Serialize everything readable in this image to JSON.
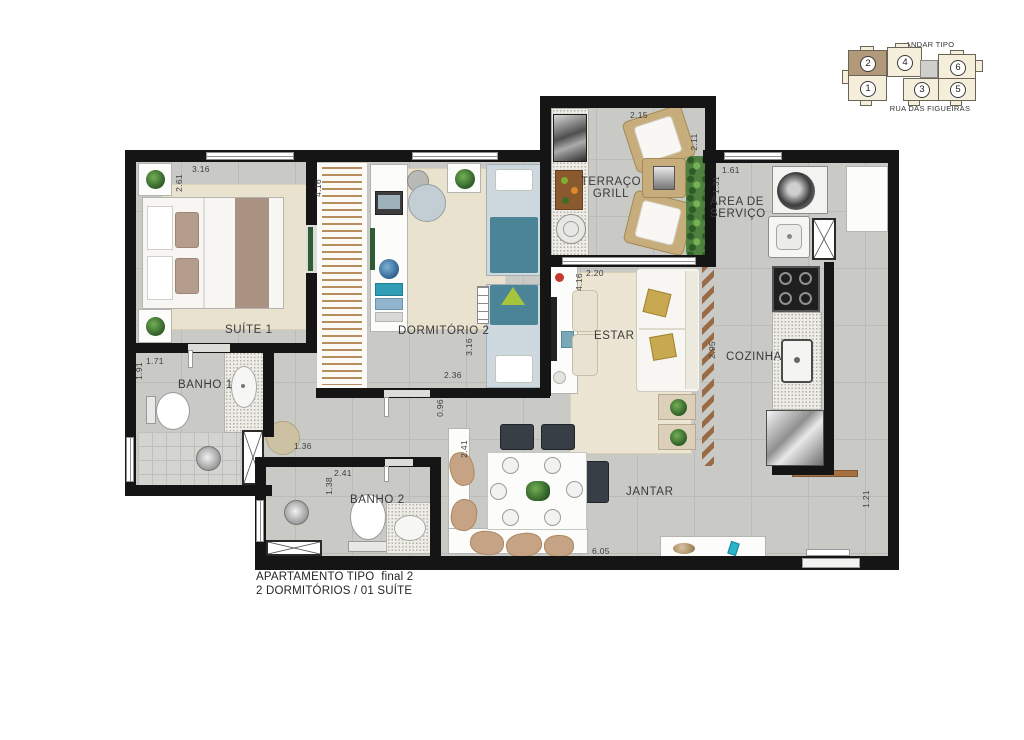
{
  "plan": {
    "caption_line1": "APARTAMENTO TIPO  final 2",
    "caption_line2": "2 DORMITÓRIOS / 01 SUÍTE"
  },
  "key_plan": {
    "title": "ANDAR TIPO",
    "street": "RUA DAS FIGUEIRAS",
    "highlighted_unit": "2",
    "units": [
      {
        "number": "2",
        "highlighted": true
      },
      {
        "number": "4",
        "highlighted": false
      },
      {
        "number": "6",
        "highlighted": false
      },
      {
        "number": "1",
        "highlighted": false
      },
      {
        "number": "3",
        "highlighted": false
      },
      {
        "number": "5",
        "highlighted": false
      }
    ]
  },
  "rooms": [
    {
      "id": "suite-1",
      "label": "SUÍTE 1"
    },
    {
      "id": "banho-1",
      "label": "BANHO 1"
    },
    {
      "id": "dormitorio-2",
      "label": "DORMITÓRIO 2"
    },
    {
      "id": "terraco-grill",
      "label": "TERRAÇO\nGRILL"
    },
    {
      "id": "area-de-servico",
      "label": "ÁREA DE\nSERVIÇO"
    },
    {
      "id": "estar",
      "label": "ESTAR"
    },
    {
      "id": "cozinha",
      "label": "COZINHA"
    },
    {
      "id": "jantar",
      "label": "JANTAR"
    },
    {
      "id": "banho-2",
      "label": "BANHO 2"
    }
  ],
  "dimensions_m": [
    {
      "id": "suite1-width",
      "value": "3.16"
    },
    {
      "id": "suite1-depth",
      "value": "2.61"
    },
    {
      "id": "closet-corridor-length",
      "value": "4.16"
    },
    {
      "id": "terraco-width",
      "value": "2.15"
    },
    {
      "id": "terraco-depth",
      "value": "2.11"
    },
    {
      "id": "servico-width",
      "value": "1.61"
    },
    {
      "id": "servico-depth",
      "value": "1.31"
    },
    {
      "id": "estar-width",
      "value": "2.20"
    },
    {
      "id": "estar-depth",
      "value": "4.16"
    },
    {
      "id": "cozinha-depth",
      "value": "2.95"
    },
    {
      "id": "banho1-width",
      "value": "1.71"
    },
    {
      "id": "banho1-depth",
      "value": "1.91"
    },
    {
      "id": "hall-nicho-width",
      "value": "1.36"
    },
    {
      "id": "banho2-width",
      "value": "2.41"
    },
    {
      "id": "banho2-depth",
      "value": "1.38"
    },
    {
      "id": "hall-width",
      "value": "0.96"
    },
    {
      "id": "dorm2-width",
      "value": "2.36"
    },
    {
      "id": "dorm2-depth",
      "value": "3.16"
    },
    {
      "id": "jantar-depth",
      "value": "2.41"
    },
    {
      "id": "jantar-width",
      "value": "6.05"
    },
    {
      "id": "entry-width",
      "value": "1.21"
    }
  ],
  "colors": {
    "wall": "#151515",
    "floor": "#c9c9c6",
    "rug": "#e9e2cf",
    "bed_teal": "#4a8496",
    "wood_slat": "#b98d5e",
    "highlight_unit": "#b2997a"
  }
}
